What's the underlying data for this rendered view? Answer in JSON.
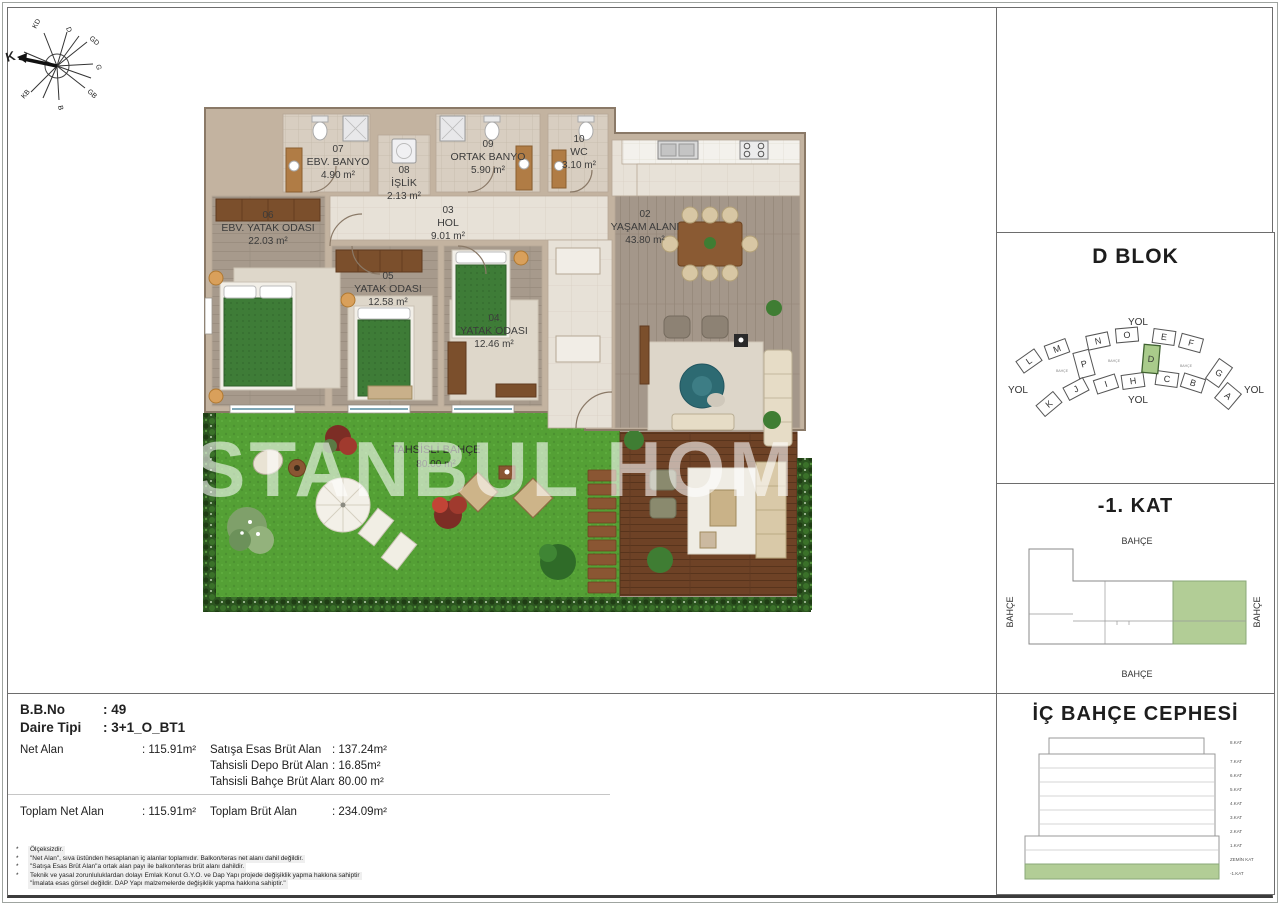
{
  "compass": {
    "labels": [
      "K",
      "KD",
      "D",
      "GD",
      "G",
      "GB",
      "B",
      "KB"
    ]
  },
  "floor_plan": {
    "watermark": "ISTANBUL HOM",
    "rooms": [
      {
        "number": "06",
        "name": "EBV. YATAK ODASI",
        "area": "22.03 m²"
      },
      {
        "number": "05",
        "name": "YATAK ODASI",
        "area": "12.58 m²"
      },
      {
        "number": "04",
        "name": "YATAK ODASI",
        "area": "12.46 m²"
      },
      {
        "number": "03",
        "name": "HOL",
        "area": "9.01 m²"
      },
      {
        "number": "02",
        "name": "YAŞAM ALANI",
        "area": "43.80 m²"
      },
      {
        "number": "07",
        "name": "EBV. BANYO",
        "area": "4.90 m²"
      },
      {
        "number": "08",
        "name": "İŞLİK",
        "area": "2.13 m²"
      },
      {
        "number": "09",
        "name": "ORTAK BANYO",
        "area": "5.90 m²"
      },
      {
        "number": "10",
        "name": "WC",
        "area": "3.10 m²"
      },
      {
        "number": "",
        "name": "TAHSİSLİ BAHÇE",
        "area": "80.00 m²"
      }
    ]
  },
  "panels": {
    "dblok": {
      "title": "D BLOK",
      "road_label": "YOL",
      "garden_label": "BAHÇE",
      "highlighted_block": "D",
      "blocks": [
        "L",
        "M",
        "N",
        "O",
        "E",
        "F",
        "P",
        "D",
        "G",
        "K",
        "J",
        "I",
        "H",
        "C",
        "B",
        "A"
      ]
    },
    "kat": {
      "title": "-1. KAT",
      "garden_label": "BAHÇE"
    },
    "cephe": {
      "title": "İÇ BAHÇE CEPHESİ",
      "floors": [
        "8.KAT",
        "7.KAT",
        "6.KAT",
        "5.KAT",
        "4.KAT",
        "3.KAT",
        "2.KAT",
        "1.KAT",
        "ZEMİN KAT",
        "-1.KAT"
      ]
    }
  },
  "info": {
    "bb_no": {
      "label": "B.B.No",
      "value": ": 49"
    },
    "daire_tipi": {
      "label": "Daire Tipi",
      "value": ": 3+1_O_BT1"
    },
    "net_alan": {
      "label": "Net Alan",
      "value": ": 115.91m²"
    },
    "satisa": {
      "label": "Satışa Esas Brüt Alan",
      "value": ": 137.24m²"
    },
    "depo": {
      "label": "Tahsisli Depo Brüt Alan",
      "value": ": 16.85m²"
    },
    "bahce": {
      "label": "Tahsisli Bahçe Brüt Alan",
      "value": ": 80.00 m²"
    },
    "toplam_net": {
      "label": "Toplam Net Alan",
      "value": ": 115.91m²"
    },
    "toplam_brut": {
      "label": "Toplam Brüt Alan",
      "value": ": 234.09m²"
    }
  },
  "footnotes": [
    {
      "mark": "*",
      "text": "Ölçeksizdir."
    },
    {
      "mark": "*",
      "text": "\"Net Alan\", sıva üstünden hesaplanan iç alanlar toplamıdır. Balkon/teras net alanı dahil değildir."
    },
    {
      "mark": "*",
      "text": "\"Satışa Esas Brüt Alan\"a ortak alan payı ile balkon/teras brüt alanı dahildir."
    },
    {
      "mark": "*",
      "text": "Teknik ve yasal zorunluluklardan dolayı Emlak Konut G.Y.O. ve Dap Yapı projede değişiklik yapma hakkına sahiptir"
    },
    {
      "mark": "",
      "text": "\"İmalata esas görsel değildir. DAP Yapı malzemelerde değişiklik yapma hakkına sahiptir.\""
    }
  ],
  "colors": {
    "highlight_green": "#a9cb8b",
    "grass": "#54a035",
    "deck": "#6e4226",
    "wall": "#c3b3a0"
  }
}
